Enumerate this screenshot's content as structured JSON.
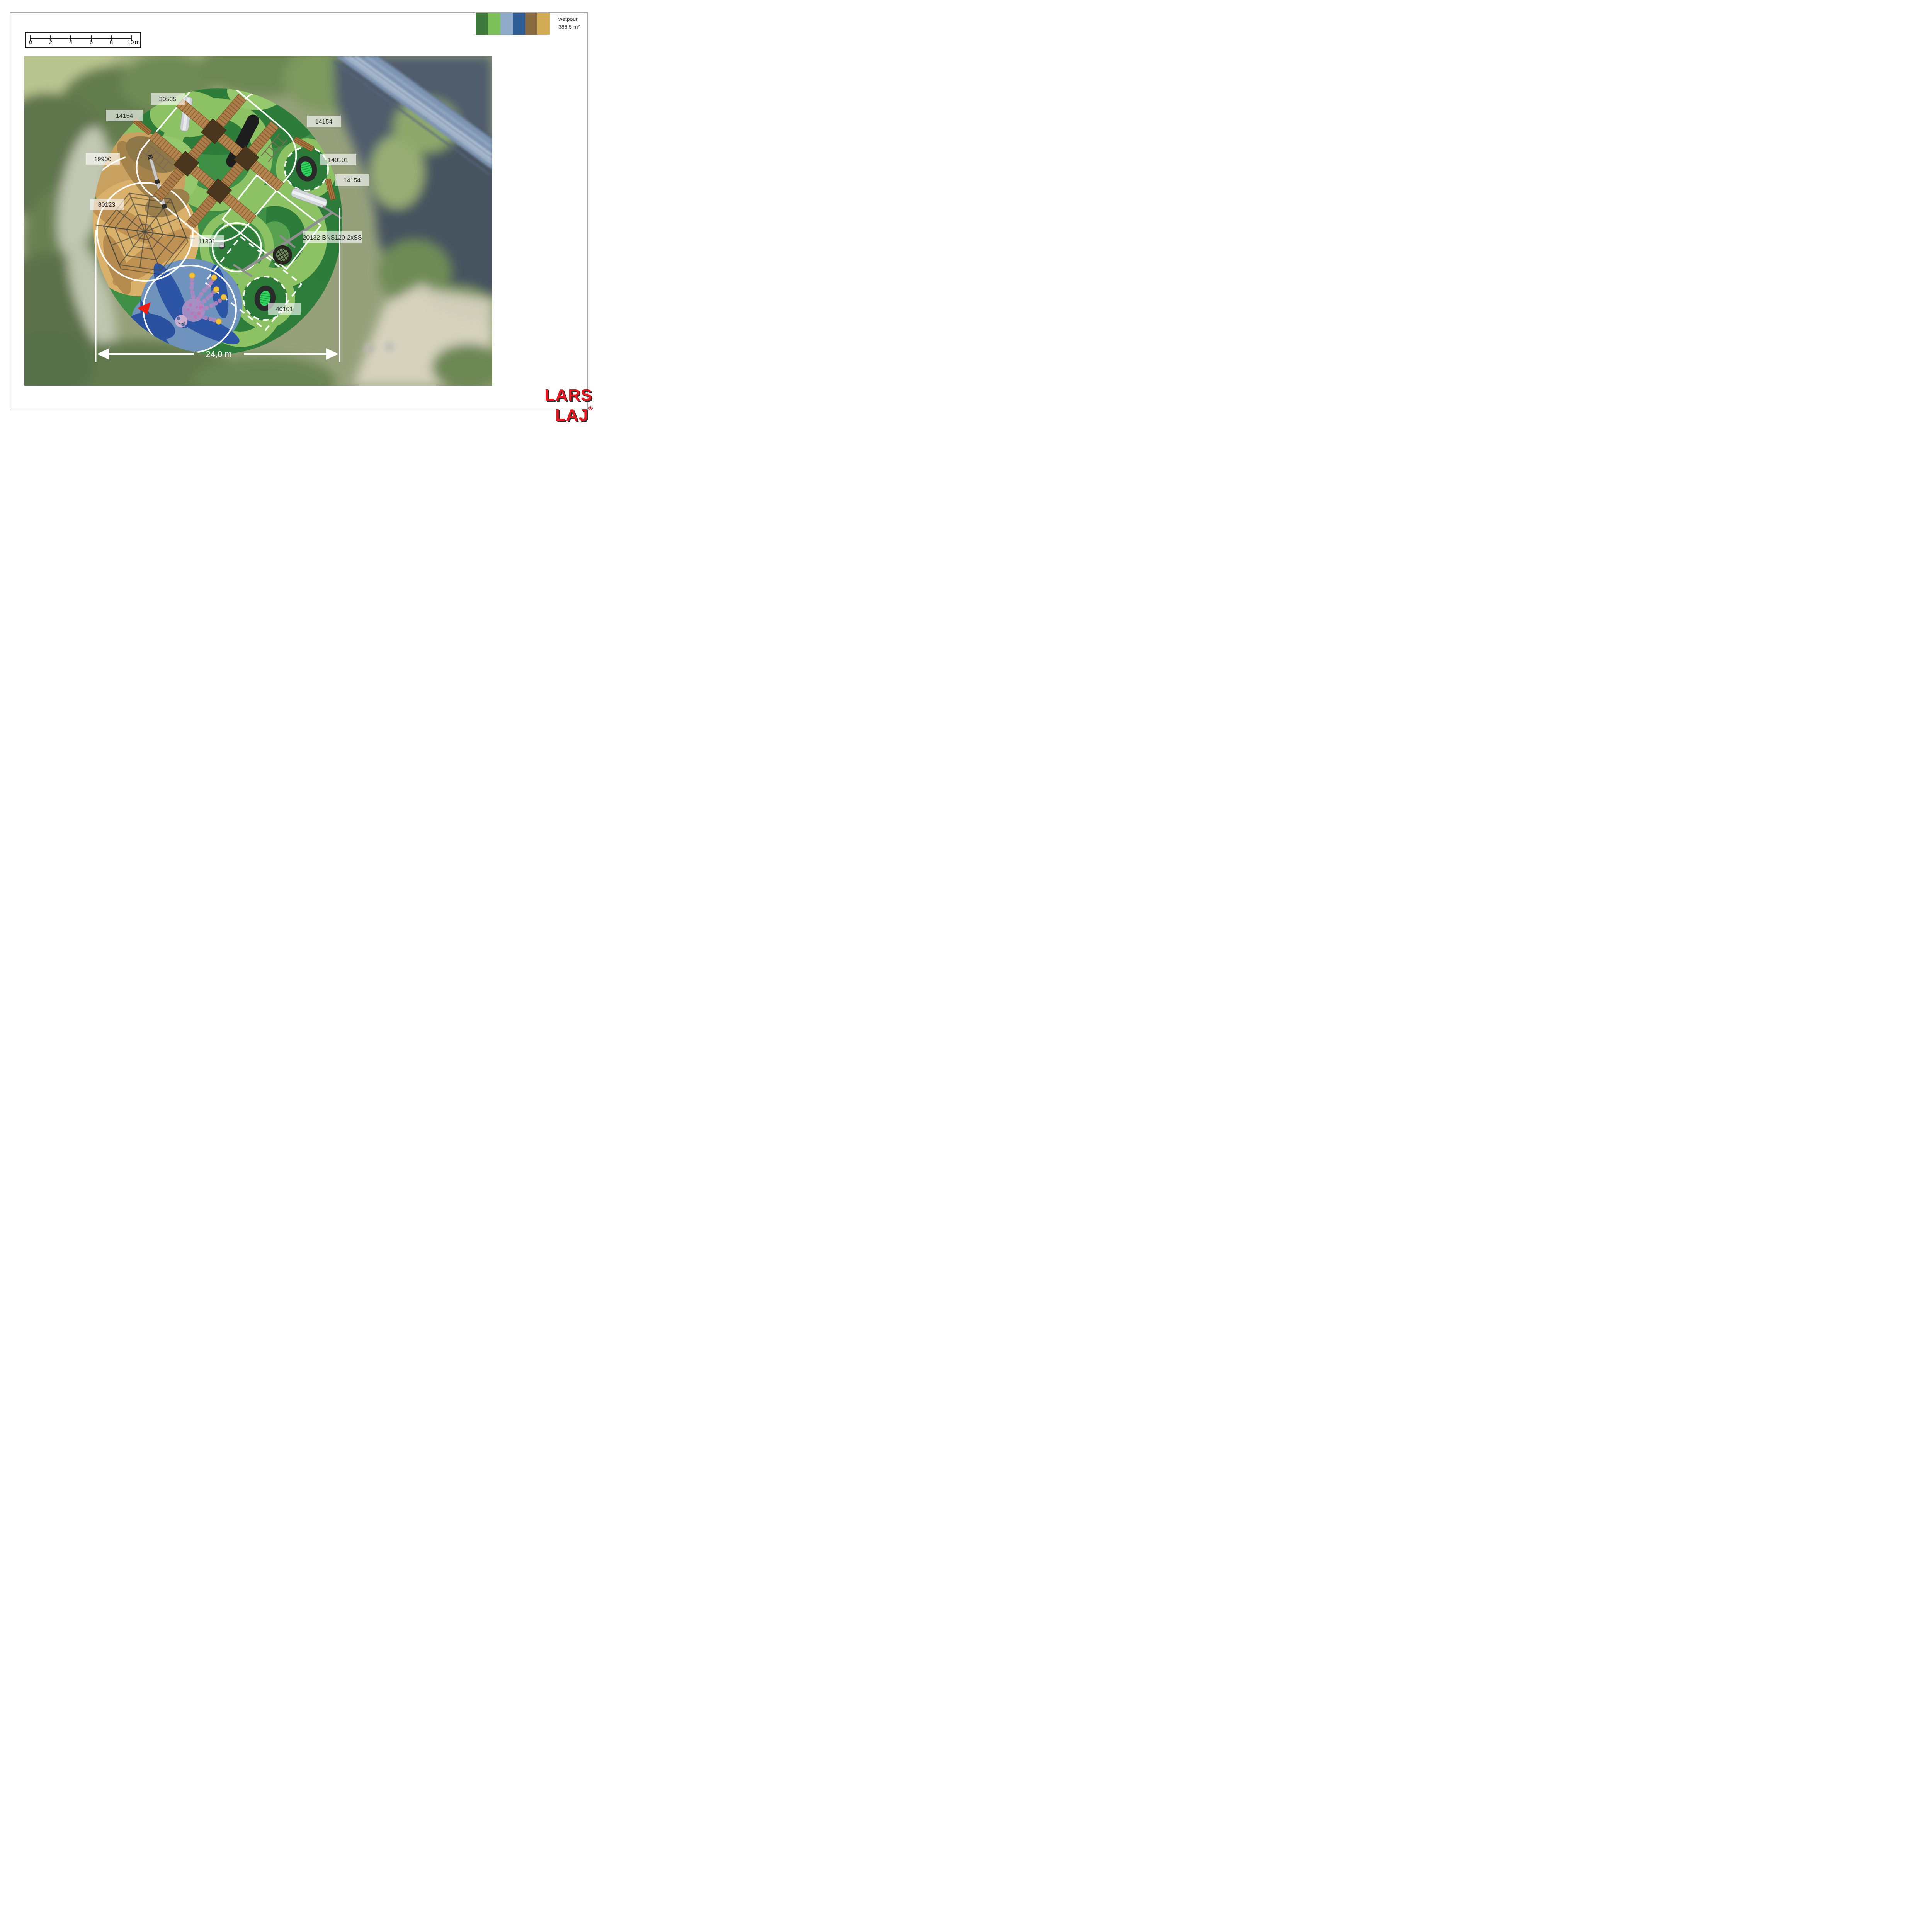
{
  "page": {
    "background": "#ffffff",
    "border_color": "#a9a9a9"
  },
  "scale_bar": {
    "tick_labels": [
      "0",
      "2",
      "4",
      "6",
      "8",
      "10"
    ],
    "unit": "m"
  },
  "legend": {
    "surface_name": "wetpour",
    "surface_area": "388,5 m²",
    "swatch_names": [
      "dark-green",
      "light-green",
      "mottled-blue",
      "dark-blue",
      "brown",
      "sand"
    ],
    "swatch_styles": [
      "background:#3d7a3c",
      "background:#7cc05a",
      "background:#8fa9c9",
      "background:#2e5d95",
      "background:#8a6a41",
      "background:#d4ab55"
    ]
  },
  "map": {
    "labels": [
      {
        "text": "30535"
      },
      {
        "text": "14154"
      },
      {
        "text": "14154"
      },
      {
        "text": "19900"
      },
      {
        "text": "140101"
      },
      {
        "text": "14154"
      },
      {
        "text": "80123"
      },
      {
        "text": "11301"
      },
      {
        "text": "20132-BNS120-2xSS"
      },
      {
        "text": "40101"
      }
    ],
    "dimension": {
      "text": "24,0 m"
    },
    "equipment": [
      "climbing-structure",
      "hexagonal-climbing-net",
      "balance-beam",
      "double-nest-swing",
      "trampoline",
      "trampoline",
      "spring-toy",
      "octopus-water-feature",
      "bench",
      "bench",
      "bench"
    ],
    "marker_color": "#e8150c"
  },
  "logo": {
    "text": "LARS LAJ",
    "registered": "®",
    "color": "#e5191f"
  }
}
